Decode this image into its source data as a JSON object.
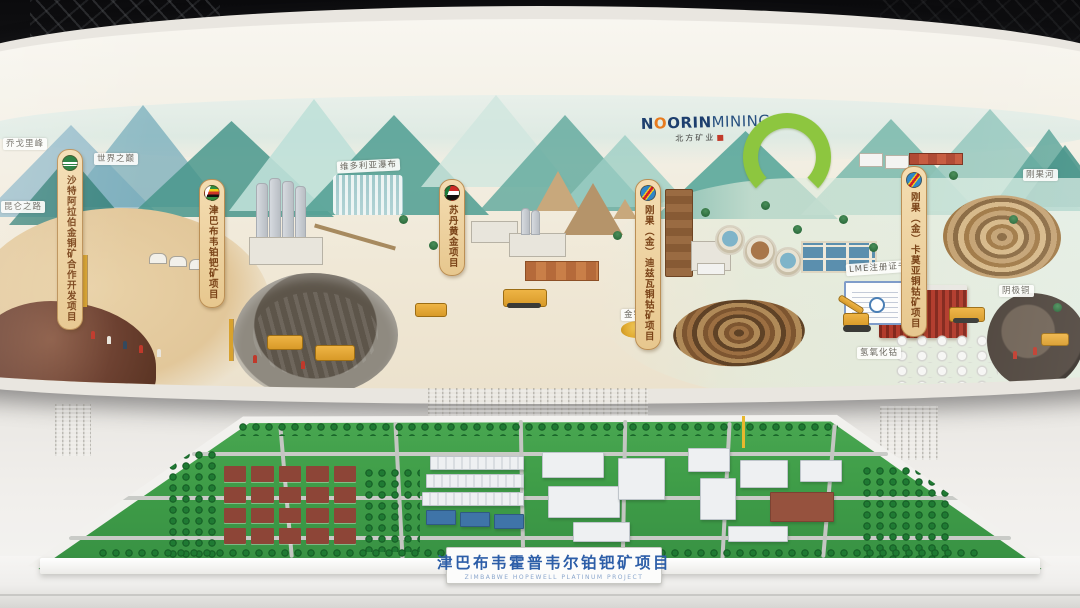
{
  "brand": {
    "name_en_1": "N",
    "name_en_2": "ORIN",
    "name_en_3": "MINING",
    "name_cn": "北方矿业"
  },
  "project_banners": [
    {
      "flag": "saudi-arabia",
      "label": "沙特阿拉伯金铜矿合作开发项目"
    },
    {
      "flag": "zimbabwe",
      "label": "津巴布韦铂钯矿项目"
    },
    {
      "flag": "sudan",
      "label": "苏丹黄金项目"
    },
    {
      "flag": "dr-congo",
      "label": "刚果（金）迪兹瓦铜钴矿项目"
    },
    {
      "flag": "dr-congo",
      "label": "刚果（金）卡莫亚铜钴矿项目"
    }
  ],
  "scene_labels": {
    "peak_k2": "乔戈里峰",
    "roof_of_world": "世界之巅",
    "kunlun_road": "昆仑之路",
    "victoria_falls": "维多利亚瀑布",
    "congo_river": "刚果河",
    "lme_certificate": "LME注册证书",
    "cobalt_hydroxide": "氢氧化钴",
    "copper_cathode": "阴极铜",
    "gold_ingots": "金锭"
  },
  "model_plaque": {
    "title_cn": "津巴布韦霍普韦尔铂钯矿项目",
    "title_en": "ZIMBABWE HOPEWELL PLATINUM PROJECT"
  },
  "colors": {
    "brand_navy": "#1d3f6e",
    "logo_green": "#8dc63f",
    "plaque_blue": "#2d5ea8"
  }
}
